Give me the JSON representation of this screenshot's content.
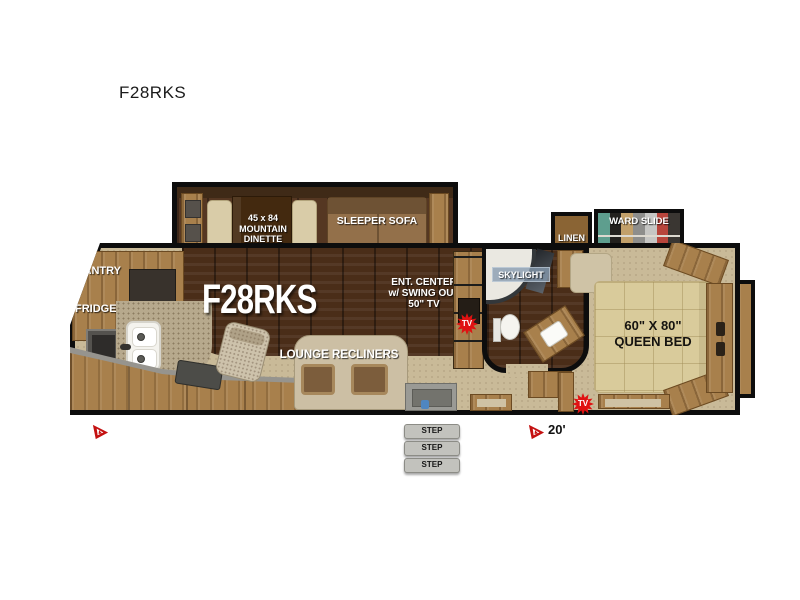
{
  "page": {
    "title": "F28RKS"
  },
  "floorplan": {
    "model_label": "F28RKS",
    "slideout": {
      "dinette_lines": [
        "45 x 84",
        "MOUNTAIN",
        "DINETTE"
      ],
      "sofa_label": "SLEEPER SOFA"
    },
    "kitchen": {
      "pantry_label": "PANTRY",
      "fridge_label": "FRIDGE"
    },
    "living": {
      "ent_center_lines": [
        "ENT. CENTER",
        "w/ SWING OUT",
        "50\" TV"
      ],
      "lounge_label": "LOUNGE RECLINERS"
    },
    "bathroom": {
      "skylight_label": "SKYLIGHT"
    },
    "bedroom": {
      "bed_lines": [
        "60\" X 80\"",
        "QUEEN BED"
      ],
      "linen_label": "LINEN",
      "ward_slide_label": "WARD SLIDE"
    },
    "badges": {
      "tv_label": "TV"
    },
    "entry": {
      "step_label": "STEP"
    },
    "awning": {
      "length_label": "20'"
    },
    "colors": {
      "outline": "#0d0d0d",
      "tan_floor": "#c9ba98",
      "dark_wood_floor": "#4a2d18",
      "cabinet_wood": "#a8804c",
      "bed_quilt": "#d9cb9b",
      "tv_badge_red": "#e01212",
      "step_gray": "#c2c2bd",
      "ward_clothes": [
        "#5e9e8e",
        "#23211e",
        "#c2a06a",
        "#8e8e8c",
        "#c6c6c4",
        "#b8453c",
        "#3a3632"
      ]
    }
  }
}
